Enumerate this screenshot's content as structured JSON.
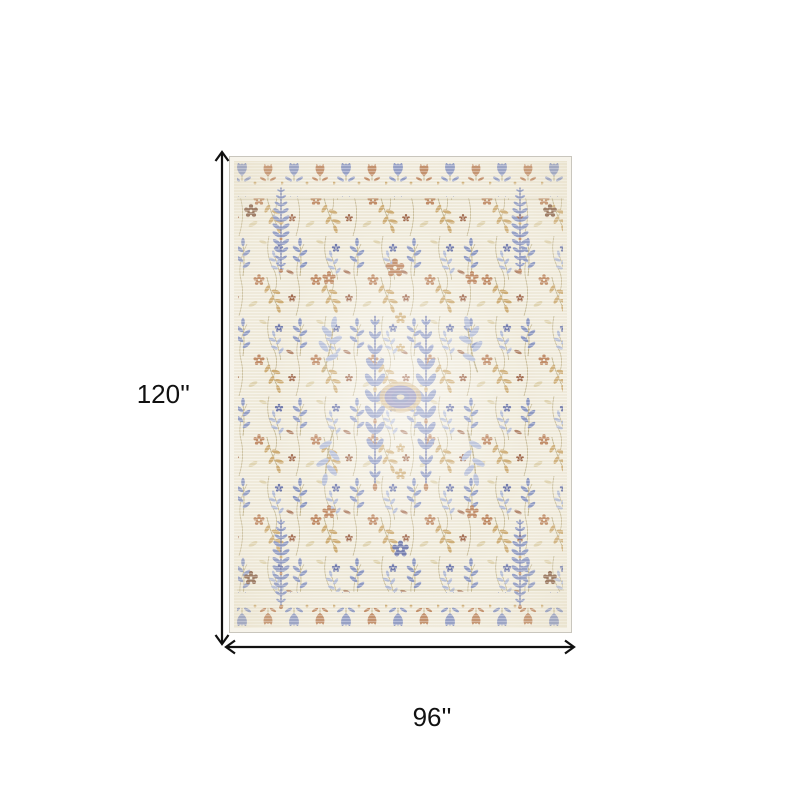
{
  "diagram": {
    "height_label": "120''",
    "width_label": "96''",
    "arrow_color": "#111111",
    "label_color": "#111111",
    "background_color": "#ffffff",
    "rug": {
      "description": "Ivory multicolor vintage-style floral area rug, portrait orientation, with periwinkle blue cypress columns, rust and gold botanical motifs and a small central medallion",
      "colors": {
        "edge": "#c9c6bd",
        "selvage": "#f6f3ea",
        "ground": "#f0ebdc",
        "ground_shade": "#e2d8bd",
        "stem": "#b3a478",
        "blue": "#7e8cc0",
        "blue_dark": "#5c68a6",
        "blue_light": "#a9b4d6",
        "rust": "#b87a52",
        "rust_dark": "#96573a",
        "brown": "#7d5138",
        "gold": "#c9a468",
        "tan": "#dccfa9",
        "purple": "#6f6da8"
      }
    }
  }
}
